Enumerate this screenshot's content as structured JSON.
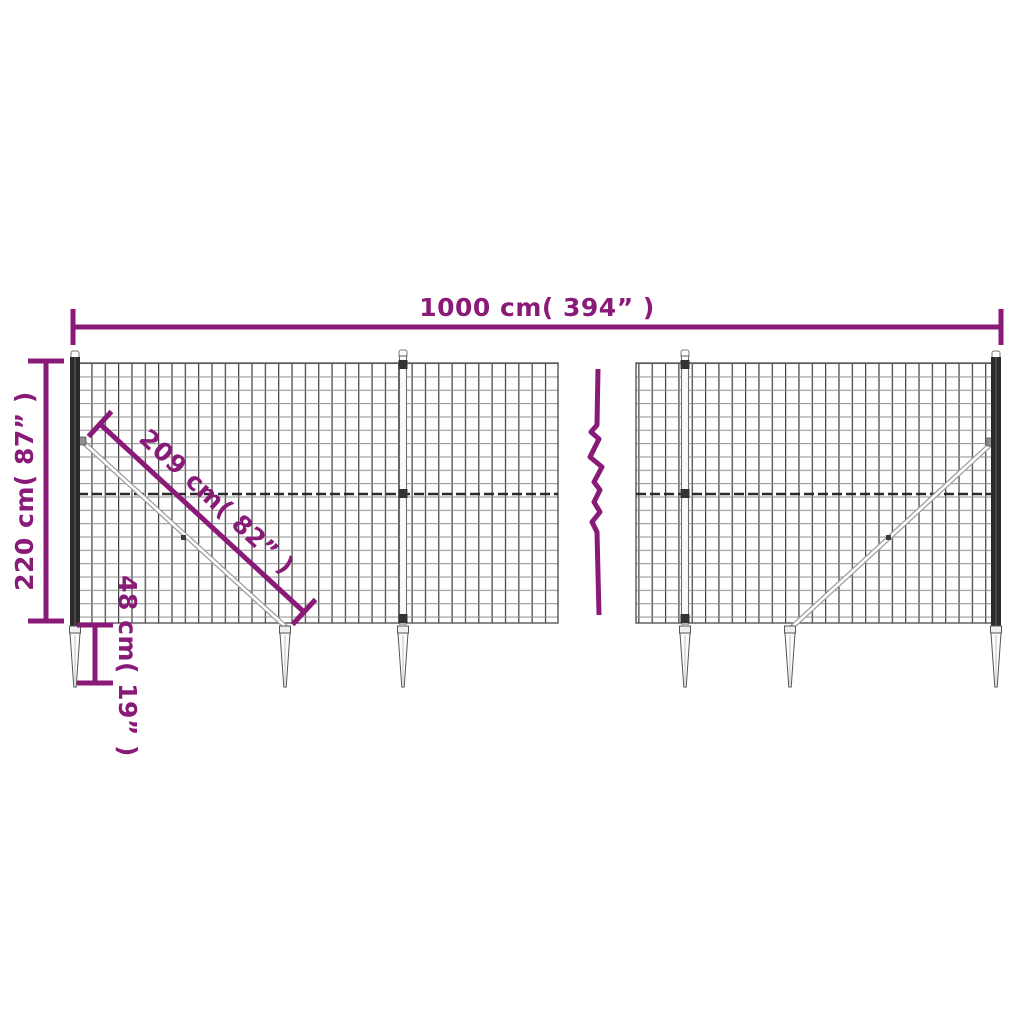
{
  "accent_color": "#8a1a78",
  "mesh_color": "#3c3c3c",
  "annotations": {
    "total_width": "1000 cm( 394” )",
    "total_height": "220 cm( 87” )",
    "brace_length": "209 cm( 82” )",
    "spike_height": "48 cm( 19” )"
  },
  "values": {
    "total_width_cm": 1000,
    "total_width_in": 394,
    "total_height_cm": 220,
    "total_height_in": 87,
    "brace_length_cm": 209,
    "brace_length_in": 82,
    "spike_height_cm": 48,
    "spike_height_in": 19
  }
}
